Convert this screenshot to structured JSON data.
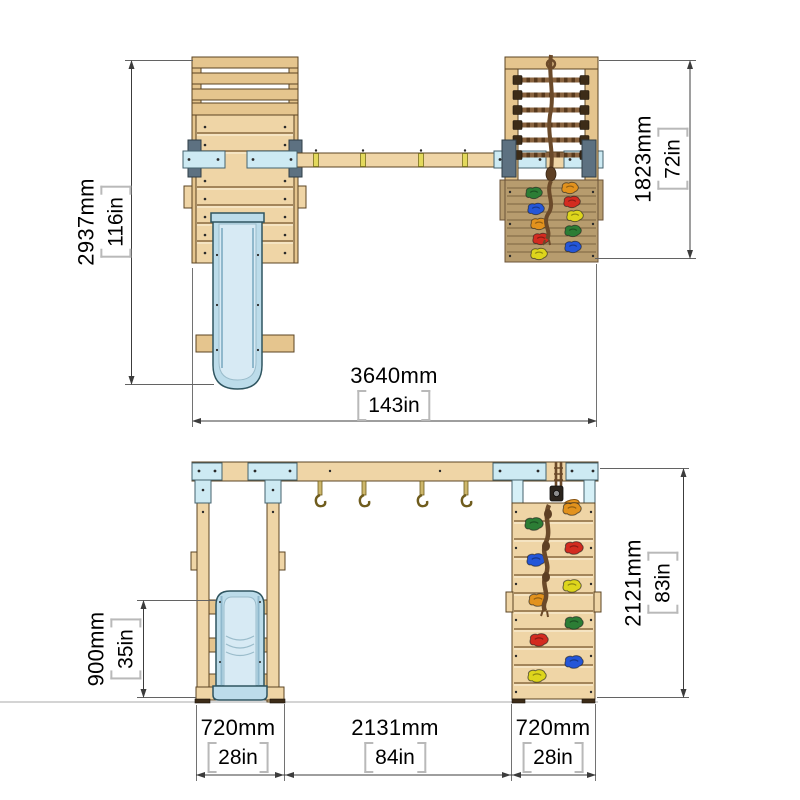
{
  "drawing": {
    "kind": "product dimension diagram",
    "views": {
      "top": "plan view",
      "front": "front elevation"
    }
  },
  "dimensions": {
    "top_view": {
      "overall_depth": {
        "mm": "2937mm",
        "inches": "116in"
      },
      "climb_module_depth": {
        "mm": "1823mm",
        "inches": "72in"
      },
      "overall_width": {
        "mm": "3640mm",
        "inches": "143in"
      }
    },
    "front_view": {
      "slide_height": {
        "mm": "900mm",
        "inches": "35in"
      },
      "frame_height": {
        "mm": "2121mm",
        "inches": "83in"
      },
      "left_bay_width": {
        "mm": "720mm",
        "inches": "28in"
      },
      "middle_bay_width": {
        "mm": "2131mm",
        "inches": "84in"
      },
      "right_bay_width": {
        "mm": "720mm",
        "inches": "28in"
      }
    }
  },
  "colors": {
    "wood_light": "#efd5a6",
    "wood_mid": "#e5c58e",
    "wood_wall_dark": "#b79c6e",
    "outline_brown": "#5b4423",
    "slide_blue": "#bcdcea",
    "slide_blue_light": "#d7eaf4",
    "bracket_steel_blue": "#cdeaf3",
    "bracket_dark_blue": "#5d7181",
    "rope_brown": "#6b4a2a",
    "hold_green": "#2c7d35",
    "hold_blue": "#2456d8",
    "hold_red": "#d32b20",
    "hold_orange": "#e2921d",
    "hold_yellow": "#ded51c",
    "pulley_handle_orange": "#e8961e",
    "dim_line_gray": "#3c3c3c",
    "bracket_gray": "#b9b9b9",
    "text_black": "#000000"
  }
}
